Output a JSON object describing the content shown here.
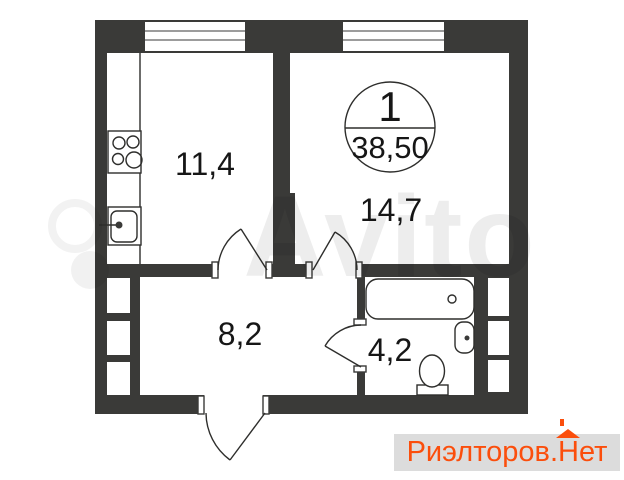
{
  "colors": {
    "wall": "#3a3a38",
    "line": "#2e2e2c",
    "label": "#161616",
    "accent": "#fb4e0c",
    "stripbg": "#dcdcdc",
    "paper": "#ffffff"
  },
  "plan": {
    "unit_badge": {
      "room_count": "1",
      "total_area": "38,50"
    },
    "rooms": {
      "kitchen": {
        "area": "11,4"
      },
      "living_room": {
        "area": "14,7"
      },
      "hallway": {
        "area": "8,2"
      },
      "bathroom": {
        "area": "4,2"
      }
    }
  },
  "watermarks": {
    "avito_text": "Avito",
    "site": {
      "prefix": "Риэлторов.",
      "house_letter": "Н",
      "suffix": "ет"
    }
  }
}
